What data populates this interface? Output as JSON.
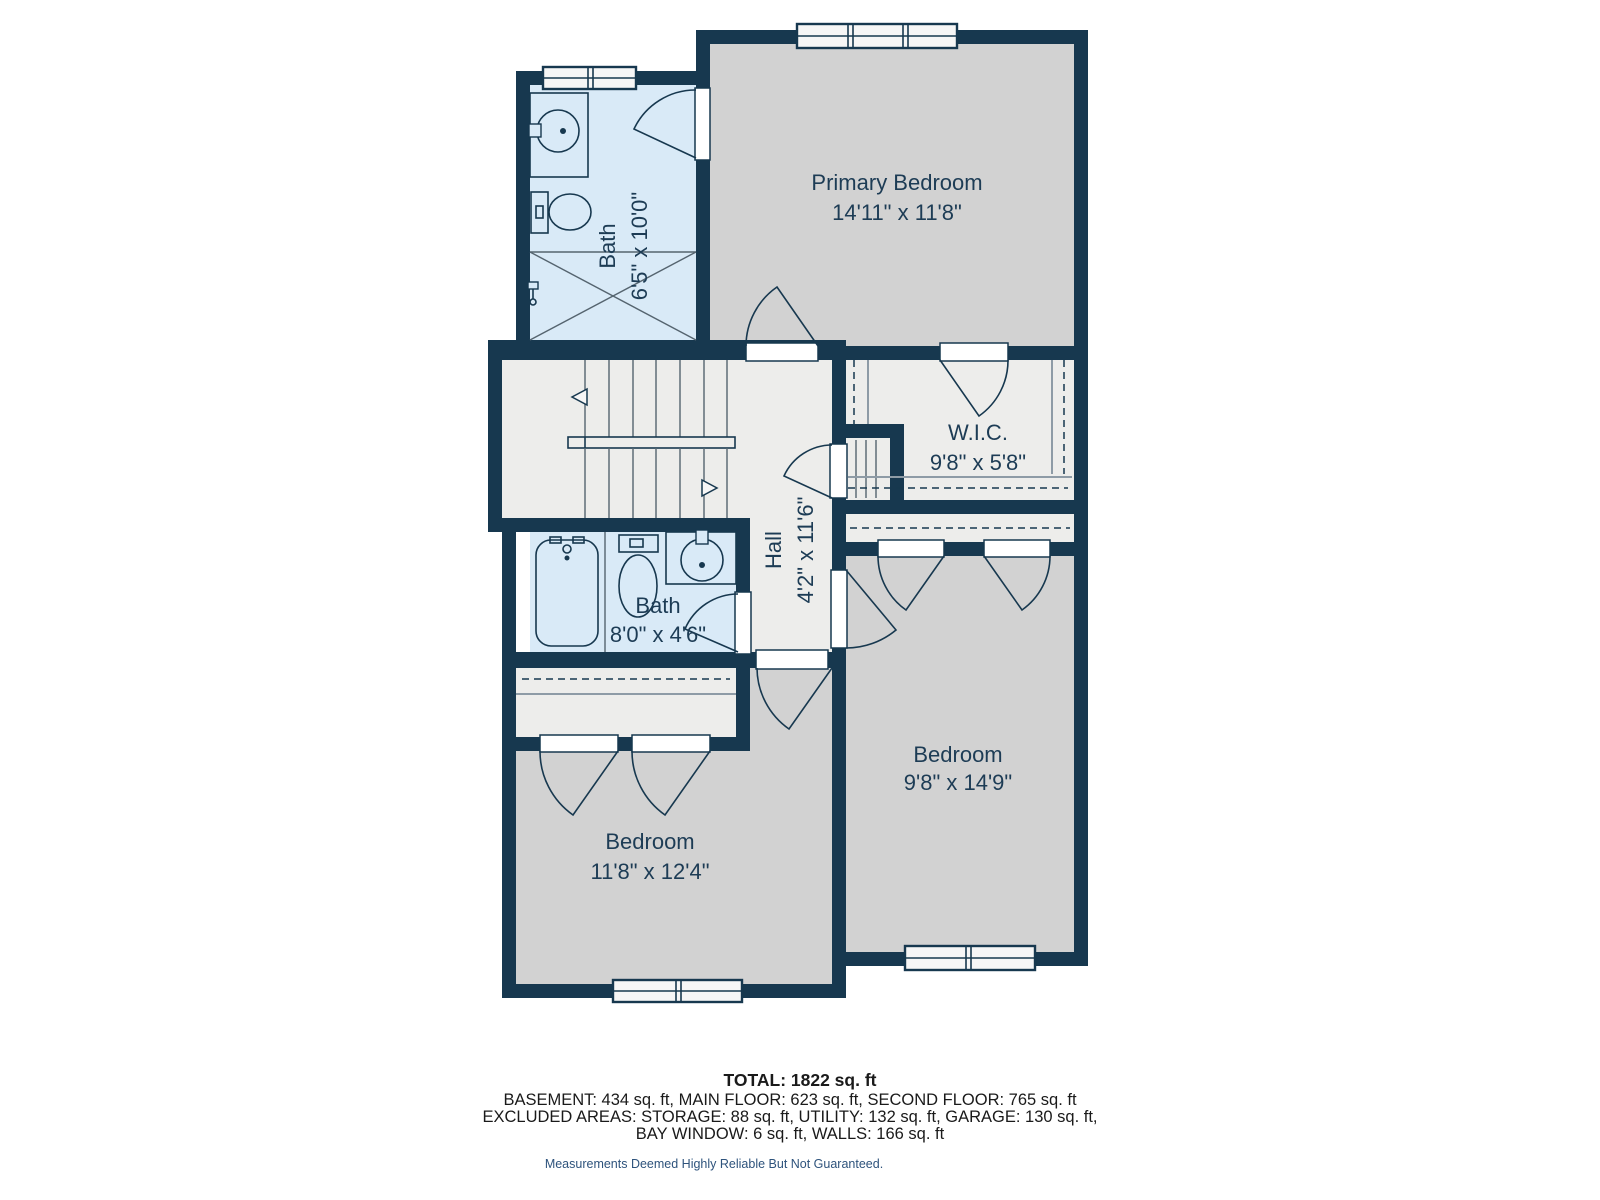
{
  "plan": {
    "rooms": {
      "bath_upper": {
        "name": "Bath",
        "dims": "6'5\" x 10'0\""
      },
      "primary_bedroom": {
        "name": "Primary Bedroom",
        "dims": "14'11\" x 11'8\""
      },
      "wic": {
        "name": "W.I.C.",
        "dims": "9'8\" x 5'8\""
      },
      "hall": {
        "name": "Hall",
        "dims": "4'2\" x 11'6\""
      },
      "bath_lower": {
        "name": "Bath",
        "dims": "8'0\" x 4'6\""
      },
      "bedroom_left": {
        "name": "Bedroom",
        "dims": "11'8\" x 12'4\""
      },
      "bedroom_right": {
        "name": "Bedroom",
        "dims": "9'8\" x 14'9\""
      }
    },
    "colors": {
      "wall": "#17384F",
      "bath": "#D9EAF7",
      "bedroom": "#D2D2D2",
      "floor": "#EDEDEB",
      "label": "#1D3C55",
      "tread": "#55646F",
      "shelf": "#8E9BA6",
      "footer": "#1A1A1A",
      "disclaimer": "#2E537C"
    }
  },
  "footer": {
    "total": "TOTAL: 1822 sq. ft",
    "line_floors": "BASEMENT: 434 sq. ft, MAIN FLOOR: 623 sq. ft, SECOND FLOOR: 765 sq. ft",
    "line_excluded_1": "EXCLUDED AREAS: STORAGE: 88 sq. ft, UTILITY: 132 sq. ft, GARAGE: 130 sq. ft,",
    "line_excluded_2": "BAY WINDOW: 6 sq. ft, WALLS: 166 sq. ft",
    "disclaimer": "Measurements Deemed Highly Reliable But Not Guaranteed."
  }
}
